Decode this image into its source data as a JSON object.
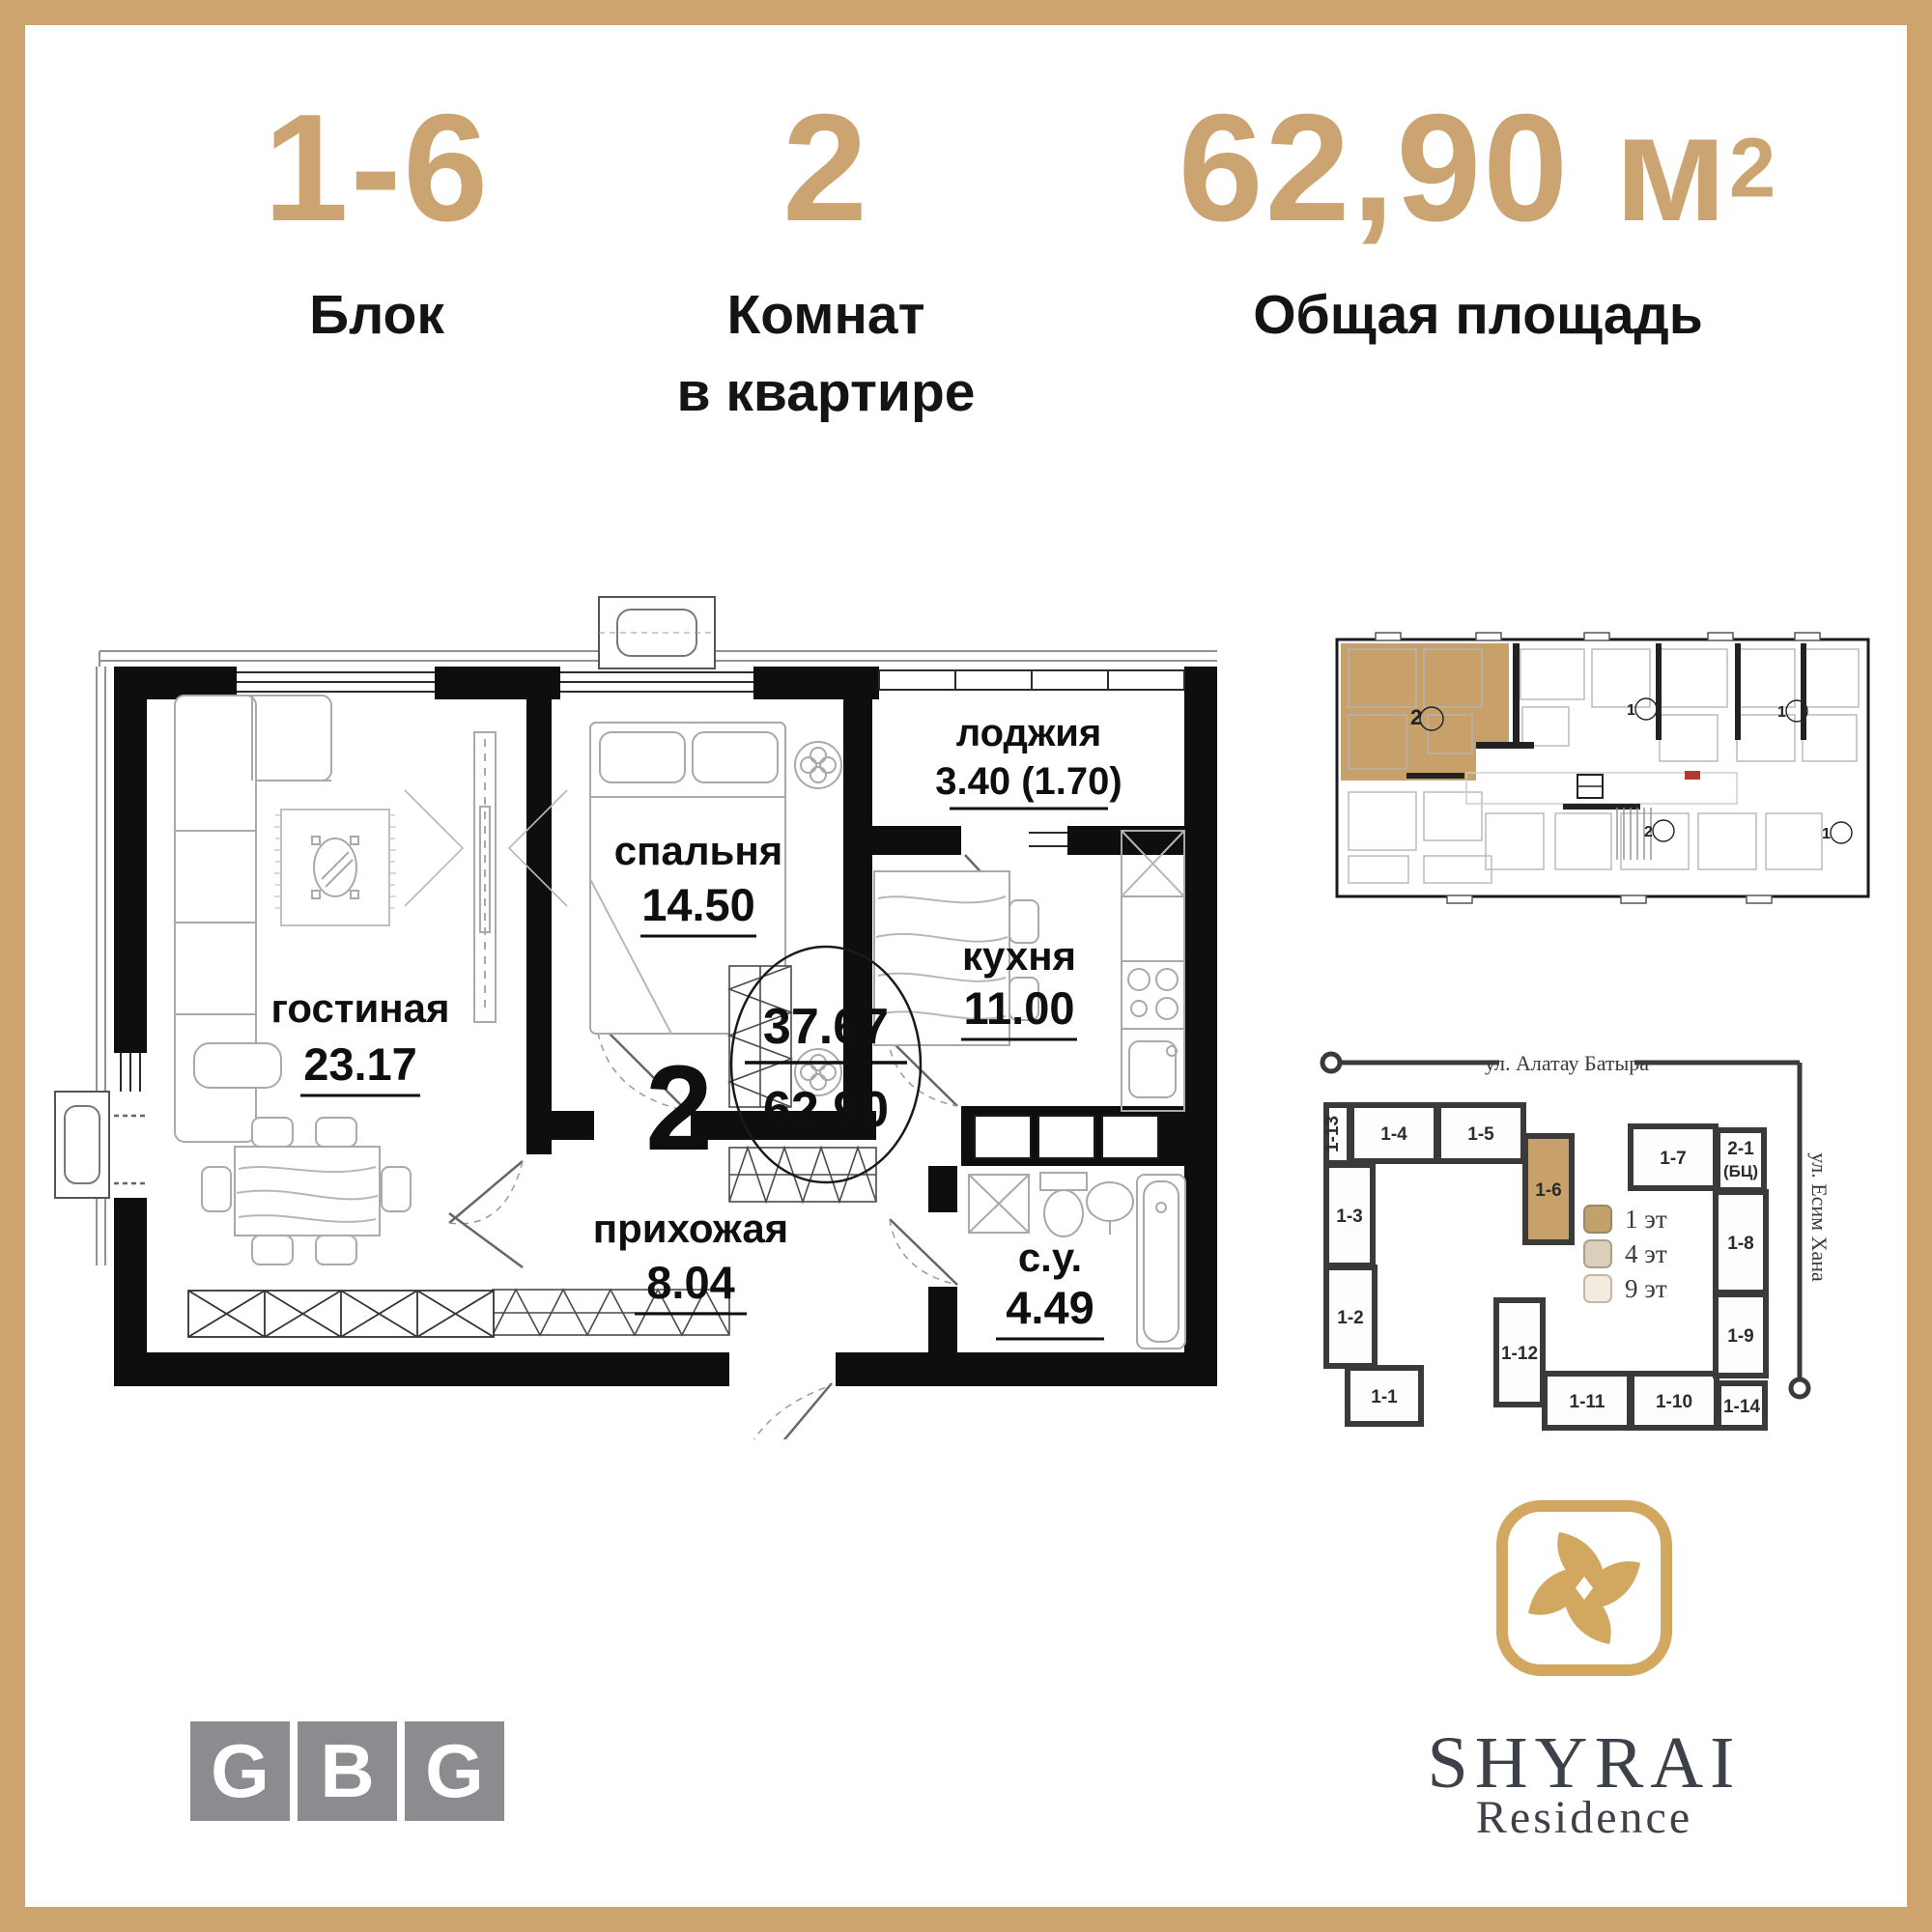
{
  "colors": {
    "gold_frame": "#CDA46E",
    "gold_text": "#CCA472",
    "ink": "#141414",
    "plan_black": "#0E0E0E",
    "tan_highlight": "#C7A06A",
    "gbg_gray": "#8B8B90",
    "shyrai_gold": "#D2A75F",
    "shyrai_ink": "#3C414A"
  },
  "header": {
    "stats": [
      {
        "value": "1-6",
        "label_lines": [
          "Блок"
        ]
      },
      {
        "value": "2",
        "label_lines": [
          "Комнат",
          "в квартире"
        ]
      },
      {
        "value": "62,90",
        "unit": "м",
        "unit_sup": "2",
        "label_lines": [
          "Общая площадь"
        ]
      }
    ]
  },
  "floor_plan": {
    "rooms": {
      "living": {
        "name": "гостиная",
        "area": "23.17"
      },
      "bedroom": {
        "name": "спальня",
        "area": "14.50"
      },
      "loggia": {
        "name": "лоджия",
        "area": "3.40 (1.70)"
      },
      "kitchen": {
        "name": "кухня",
        "area": "11.00"
      },
      "hallway": {
        "name": "прихожая",
        "area": "8.04"
      },
      "bathroom": {
        "name": "с.у.",
        "area": "4.49"
      }
    },
    "summary": {
      "rooms_count": "2",
      "living_area": "37.67",
      "total_area": "62.90"
    }
  },
  "level_plan": {
    "highlighted_unit_rooms": "2",
    "unit_marks": [
      "1",
      "1",
      "2",
      "1"
    ]
  },
  "site_plan": {
    "street_top": "ул. Алатау Батыра",
    "street_right": "ул. Есим Хана",
    "blocks": {
      "b113": "1-13",
      "b14": "1-4",
      "b15": "1-5",
      "b16": "1-6",
      "b13": "1-3",
      "b12": "1-2",
      "b11": "1-1",
      "b112": "1-12",
      "b111": "1-11",
      "b110": "1-10",
      "b114": "1-14",
      "b17": "1-7",
      "b21": "2-1",
      "b21b": "(БЦ)",
      "b18": "1-8",
      "b19": "1-9"
    },
    "legend": [
      {
        "label": "1 эт",
        "color": "#C2A26C"
      },
      {
        "label": "4 эт",
        "color": "#D9CFBB"
      },
      {
        "label": "9 эт",
        "color": "#F1EBE0"
      }
    ]
  },
  "logos": {
    "gbg": {
      "letters": [
        "G",
        "B",
        "G"
      ]
    },
    "shyrai": {
      "name": "SHYRAI",
      "sub": "Residence"
    }
  }
}
